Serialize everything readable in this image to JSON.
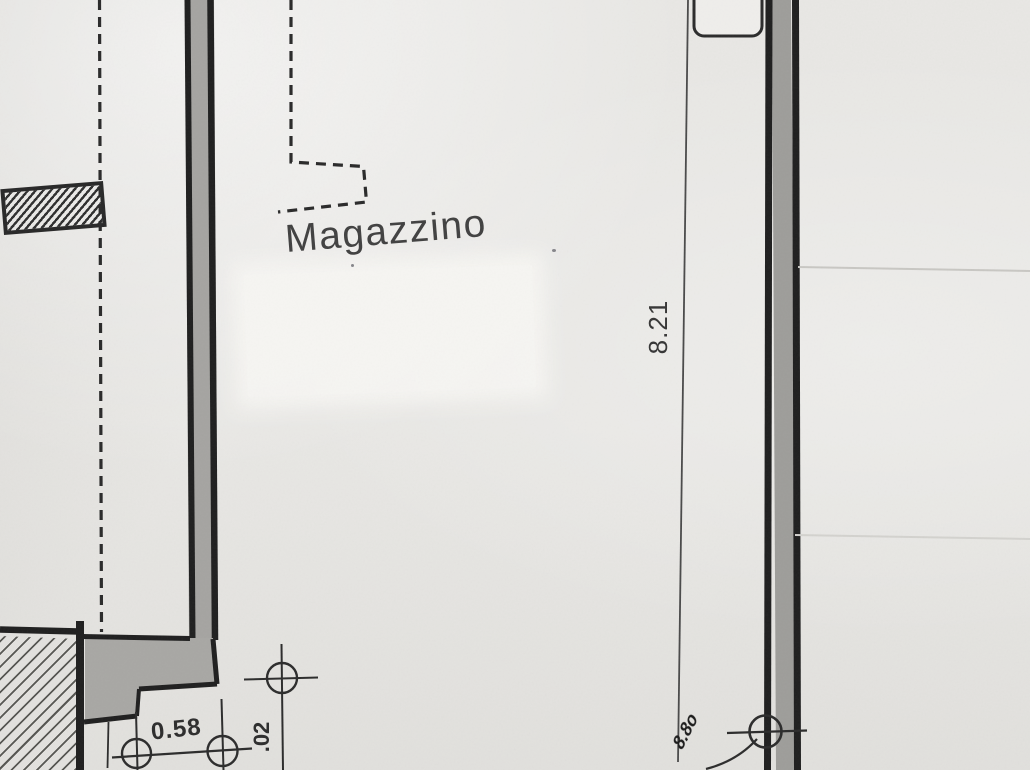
{
  "plan": {
    "room_label": "Magazzino",
    "dims": {
      "right_wall": "8.21",
      "bottom_width": "0.58",
      "bottom_height": ".02"
    },
    "handwritten_note": "8.8o",
    "colors": {
      "paper": "#e8e7e4",
      "ink": "#1f1f1f",
      "wall_fill_left": "#a5a4a1",
      "wall_fill_right": "#9e9d9a",
      "faint_line": "#c8c7c3",
      "patch": "#f7f6f3"
    }
  }
}
